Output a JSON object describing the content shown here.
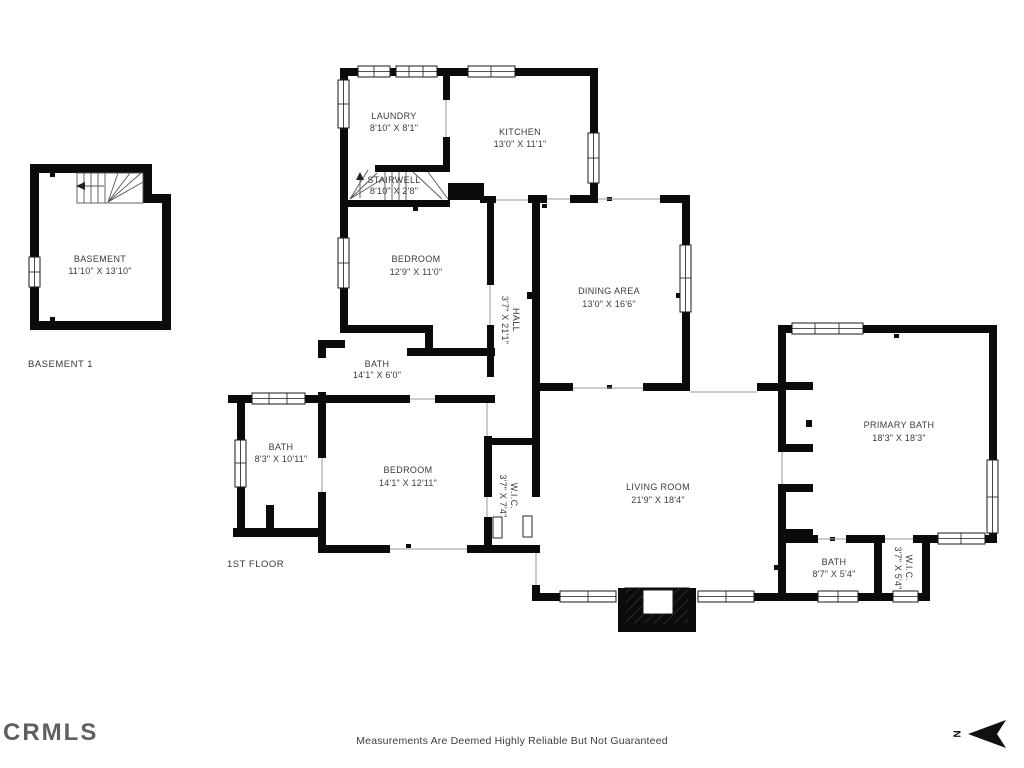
{
  "brand": {
    "logo_text": "CRMLS"
  },
  "footer": {
    "disclaimer": "Measurements Are Deemed Highly Reliable But Not Guaranteed"
  },
  "compass": {
    "label": "N"
  },
  "floor_labels": {
    "basement": "BASEMENT 1",
    "first": "1ST FLOOR"
  },
  "rooms": {
    "basement": {
      "name": "BASEMENT",
      "dims": "11'10\" X 13'10\""
    },
    "laundry": {
      "name": "LAUNDRY",
      "dims": "8'10\" X 8'1\""
    },
    "kitchen": {
      "name": "KITCHEN",
      "dims": "13'0\" X 11'1\""
    },
    "stairwell": {
      "name": "STAIRWELL",
      "dims": "8'10\" X 2'8\""
    },
    "bedroom1": {
      "name": "BEDROOM",
      "dims": "12'9\" X 11'0\""
    },
    "hall": {
      "name": "HALL",
      "dims": "3'7\" X 21'1\""
    },
    "dining": {
      "name": "DINING AREA",
      "dims": "13'0\" X 16'6\""
    },
    "bath1": {
      "name": "BATH",
      "dims": "14'1\" X 6'0\""
    },
    "bath2": {
      "name": "BATH",
      "dims": "8'3\" X 10'11\""
    },
    "bedroom2": {
      "name": "BEDROOM",
      "dims": "14'1\" X 12'11\""
    },
    "wic1": {
      "name": "W.I.C.",
      "dims": "3'7\" X 7'4\""
    },
    "living": {
      "name": "LIVING ROOM",
      "dims": "21'9\" X 18'4\""
    },
    "primary_bath": {
      "name": "PRIMARY BATH",
      "dims": "18'3\" X 18'3\""
    },
    "bath3": {
      "name": "BATH",
      "dims": "8'7\" X 5'4\""
    },
    "wic2": {
      "name": "W.I.C.",
      "dims": "3'7\" X 5'4\""
    }
  }
}
